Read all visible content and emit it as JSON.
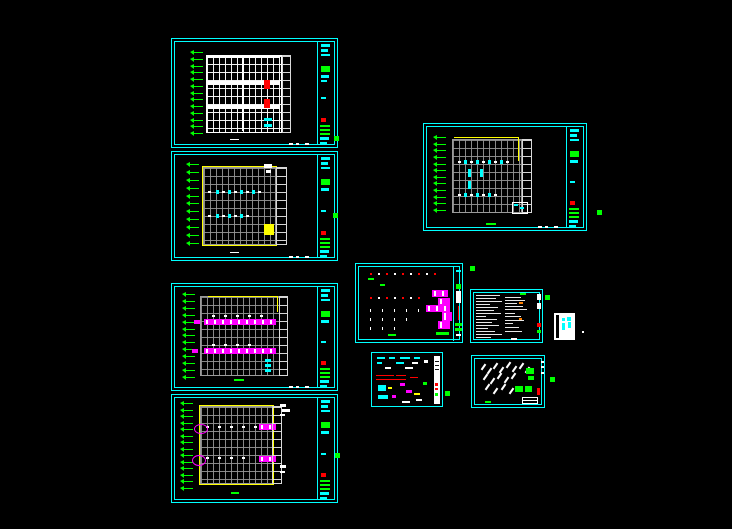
{
  "app": {
    "name": "CAD model space",
    "background": "#000000"
  },
  "palette": {
    "frame_border": "#00ffff",
    "grid_bright": "#ffffff",
    "grid_dim": "#9a9a9a",
    "axis_marker_green": "#00ff00",
    "highlight_magenta": "#ff00ff",
    "highlight_yellow": "#ffff00",
    "highlight_red": "#ff0000",
    "note_orange": "#ff7f00"
  },
  "sheets": [
    {
      "id": "s1",
      "kind": "framing-grid-plan",
      "x": 171,
      "y": 38,
      "w": 167,
      "h": 110,
      "axis_arrows": 13
    },
    {
      "id": "s2",
      "kind": "framing-grid-plan",
      "x": 171,
      "y": 151,
      "w": 167,
      "h": 110,
      "axis_arrows": 11
    },
    {
      "id": "s3",
      "kind": "framing-grid-plan",
      "x": 171,
      "y": 283,
      "w": 167,
      "h": 108,
      "axis_arrows": 13
    },
    {
      "id": "s4",
      "kind": "framing-grid-plan",
      "x": 171,
      "y": 394,
      "w": 167,
      "h": 109,
      "axis_arrows": 14
    },
    {
      "id": "s5",
      "kind": "framing-grid-plan",
      "x": 423,
      "y": 123,
      "w": 164,
      "h": 108,
      "axis_arrows": 12
    },
    {
      "id": "s6",
      "kind": "schedule-plan",
      "x": 355,
      "y": 263,
      "w": 108,
      "h": 80,
      "axis_arrows": 0
    },
    {
      "id": "s7",
      "kind": "detail-sheet",
      "x": 371,
      "y": 352,
      "w": 72,
      "h": 55,
      "axis_arrows": 0
    },
    {
      "id": "s8",
      "kind": "notes-sheet",
      "x": 470,
      "y": 289,
      "w": 73,
      "h": 54,
      "axis_arrows": 0
    },
    {
      "id": "s9",
      "kind": "section-details",
      "x": 471,
      "y": 355,
      "w": 74,
      "h": 53,
      "axis_arrows": 0
    },
    {
      "id": "s10",
      "kind": "legend-card",
      "x": 554,
      "y": 313,
      "w": 21,
      "h": 27,
      "axis_arrows": 0
    }
  ],
  "markers": [
    {
      "x": 334,
      "y": 136
    },
    {
      "x": 333,
      "y": 213
    },
    {
      "x": 597,
      "y": 210
    },
    {
      "x": 470,
      "y": 266
    },
    {
      "x": 545,
      "y": 295
    },
    {
      "x": 550,
      "y": 377
    },
    {
      "x": 445,
      "y": 391
    },
    {
      "x": 335,
      "y": 453
    }
  ],
  "stray_dot": {
    "x": 582,
    "y": 331
  }
}
